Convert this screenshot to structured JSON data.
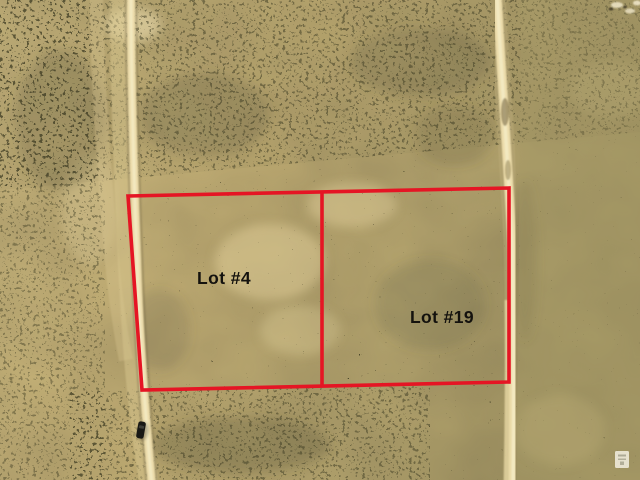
{
  "lots": [
    {
      "label": "Lot #4"
    },
    {
      "label": "Lot #19"
    }
  ],
  "colors": {
    "boundary_red": "#e51524",
    "label_text": "#14120e",
    "terrain_base": "#c2ae74",
    "terrain_speckle": "#34321f",
    "road_cream": "#ecdcaa",
    "road_highlight": "#f5ebc6",
    "vehicle_black": "#181815",
    "watermark_white": "#f3efe2"
  }
}
